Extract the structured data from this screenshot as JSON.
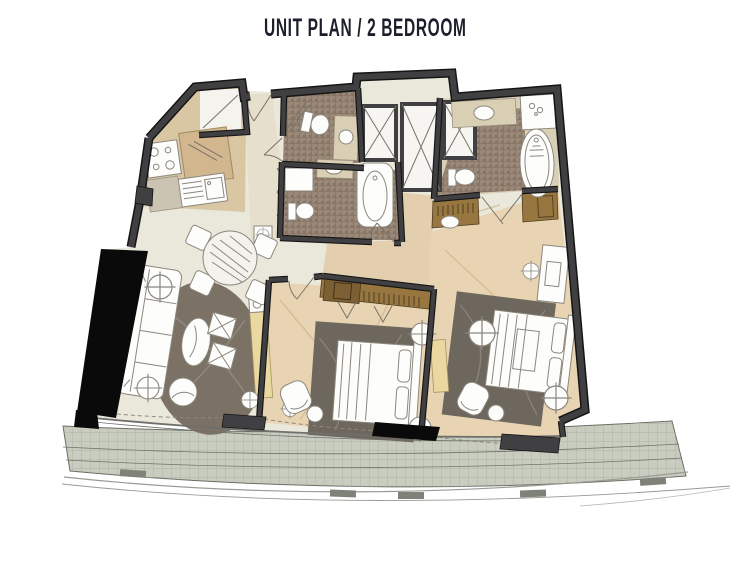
{
  "header": {
    "title": "UNIT PLAN / 2 BEDROOM"
  },
  "palette": {
    "title_color": "#1c1e2b",
    "wall": "#404042",
    "wall_outline": "#151515",
    "column": "#0a0a0a",
    "floor_main": "#eae7db",
    "floor_kitchen": "#d9c7a4",
    "floor_entry": "#e6dfcb",
    "floor_bath": "#8c7767",
    "floor_bedroom": "#e8d4b2",
    "floor_hall": "#e3cfae",
    "floor_shaft": "#f6f5f1",
    "vanity": "#d8cfb4",
    "rug_living": "#7b7165",
    "rug_bedroom": "#6e675e",
    "wood_wardrobe": "#97773f",
    "wood_cabinet": "#7c5f33",
    "console": "#e9d8a0",
    "island": "#d2b68e",
    "counter": "#ccc4b2",
    "balcony": "#c9cdc0",
    "balcony_grid": "#a6ab9c",
    "rail": "#9a9a94"
  }
}
